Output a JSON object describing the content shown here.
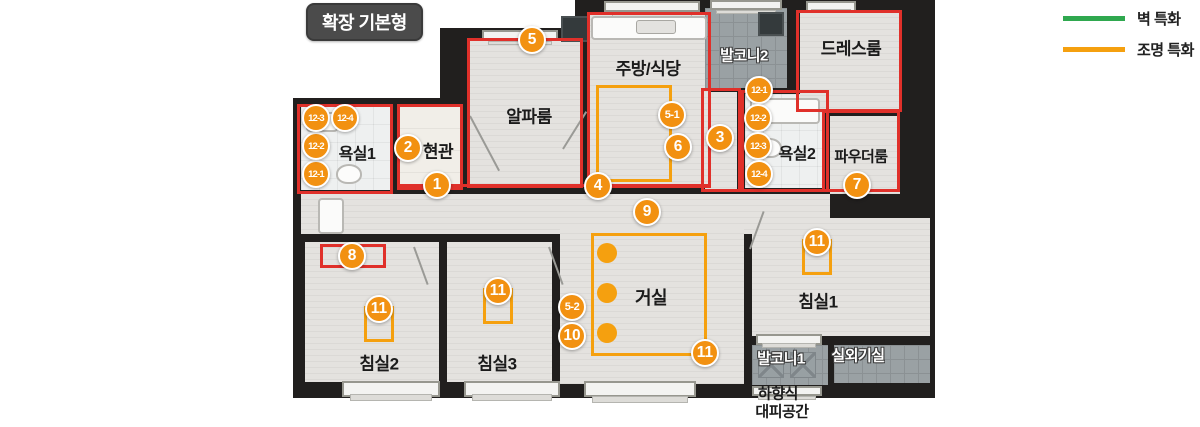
{
  "title": "확장 기본형",
  "legend": {
    "items": [
      {
        "label": "벽 특화",
        "color": "#2fa84f"
      },
      {
        "label": "조명 특화",
        "color": "#f5a00f"
      }
    ]
  },
  "colors": {
    "wall": "#211f1e",
    "wall_highlight_red": "#e0302a",
    "lighting_orange": "#f5a00f",
    "marker_orange": "#f29111",
    "legend_green": "#2fa84f"
  },
  "plan": {
    "walls": [
      [
        293,
        98,
        167,
        300
      ],
      [
        440,
        28,
        150,
        370
      ],
      [
        575,
        0,
        360,
        398
      ]
    ],
    "floors": [
      {
        "kind": "bath",
        "r": [
          301,
          106,
          90,
          84
        ]
      },
      {
        "kind": "entry",
        "r": [
          399,
          106,
          62,
          84
        ]
      },
      {
        "kind": "wood",
        "r": [
          469,
          40,
          112,
          146
        ]
      },
      {
        "kind": "wood",
        "r": [
          589,
          14,
          120,
          172
        ]
      },
      {
        "kind": "wood",
        "r": [
          705,
          92,
          32,
          98
        ]
      },
      {
        "kind": "bath",
        "r": [
          745,
          94,
          80,
          94
        ]
      },
      {
        "kind": "balcony",
        "r": [
          705,
          8,
          82,
          80
        ]
      },
      {
        "kind": "wood",
        "r": [
          800,
          12,
          100,
          98
        ]
      },
      {
        "kind": "wood",
        "r": [
          830,
          116,
          70,
          78
        ]
      },
      {
        "kind": "wood",
        "r": [
          301,
          194,
          529,
          40
        ]
      },
      {
        "kind": "wood",
        "r": [
          560,
          228,
          184,
          156
        ]
      },
      {
        "kind": "wood",
        "r": [
          305,
          242,
          134,
          140
        ]
      },
      {
        "kind": "wood",
        "r": [
          447,
          242,
          105,
          140
        ]
      },
      {
        "kind": "wood",
        "r": [
          752,
          218,
          178,
          118
        ]
      },
      {
        "kind": "balcony",
        "r": [
          752,
          345,
          76,
          40
        ]
      },
      {
        "kind": "balcony",
        "r": [
          834,
          345,
          96,
          38
        ]
      }
    ],
    "windows": [
      [
        604,
        1,
        96,
        11
      ],
      [
        710,
        0,
        72,
        10
      ],
      [
        806,
        1,
        50,
        11
      ],
      [
        482,
        30,
        76,
        10
      ],
      [
        342,
        381,
        98,
        16
      ],
      [
        464,
        381,
        96,
        16
      ],
      [
        584,
        381,
        112,
        16
      ],
      [
        756,
        334,
        66,
        11
      ],
      [
        752,
        386,
        70,
        10
      ]
    ],
    "red_boxes": [
      [
        297,
        104,
        96,
        90
      ],
      [
        397,
        104,
        66,
        86
      ],
      [
        467,
        38,
        116,
        150
      ],
      [
        587,
        12,
        124,
        176
      ],
      [
        701,
        88,
        40,
        104
      ],
      [
        741,
        90,
        88,
        102
      ],
      [
        796,
        10,
        106,
        102
      ],
      [
        822,
        110,
        78,
        82
      ],
      [
        320,
        244,
        66,
        24
      ]
    ],
    "red_lines": [
      [
        399,
        184,
        312,
        3
      ]
    ],
    "orange_boxes": [
      [
        596,
        85,
        76,
        97
      ],
      [
        591,
        233,
        116,
        123
      ]
    ],
    "u_shapes": [
      [
        364,
        306,
        30,
        36
      ],
      [
        483,
        288,
        30,
        36
      ],
      [
        802,
        239,
        30,
        36
      ]
    ],
    "dots": [
      [
        607,
        253
      ],
      [
        607,
        293
      ],
      [
        607,
        333
      ]
    ],
    "fixtures": [
      {
        "kind": "white",
        "r": [
          591,
          16,
          116,
          24
        ]
      },
      {
        "kind": "gray",
        "r": [
          636,
          20,
          40,
          14
        ]
      },
      {
        "kind": "oval",
        "r": [
          336,
          164,
          26,
          20
        ]
      },
      {
        "kind": "white",
        "r": [
          306,
          112,
          32,
          20
        ]
      },
      {
        "kind": "white",
        "r": [
          318,
          198,
          26,
          36
        ]
      },
      {
        "kind": "white",
        "r": [
          750,
          98,
          70,
          26
        ]
      },
      {
        "kind": "oval",
        "r": [
          758,
          138,
          24,
          20
        ]
      },
      {
        "kind": "shaft",
        "r": [
          561,
          16,
          28,
          26
        ]
      },
      {
        "kind": "shaft",
        "r": [
          758,
          12,
          26,
          24
        ]
      },
      {
        "kind": "hatch",
        "r": [
          758,
          352,
          26,
          26
        ]
      },
      {
        "kind": "hatch",
        "r": [
          790,
          352,
          26,
          26
        ]
      }
    ],
    "door_lines": [
      {
        "x": 470,
        "y": 115,
        "len": 62,
        "angle": 62
      },
      {
        "x": 563,
        "y": 148,
        "len": 44,
        "angle": -58
      },
      {
        "x": 414,
        "y": 246,
        "len": 40,
        "angle": 70
      },
      {
        "x": 549,
        "y": 246,
        "len": 40,
        "angle": 70
      },
      {
        "x": 750,
        "y": 248,
        "len": 40,
        "angle": -70
      }
    ],
    "labels": [
      {
        "text": "욕실1",
        "x": 357,
        "y": 152,
        "variant": "dark",
        "size": 16
      },
      {
        "text": "현관",
        "x": 438,
        "y": 150,
        "variant": "dark",
        "size": 17
      },
      {
        "text": "알파룸",
        "x": 529,
        "y": 115,
        "variant": "dark",
        "size": 17
      },
      {
        "text": "주방/식당",
        "x": 648,
        "y": 67,
        "variant": "dark",
        "size": 17
      },
      {
        "text": "발코니2",
        "x": 744,
        "y": 55,
        "variant": "light",
        "size": 15
      },
      {
        "text": "드레스룸",
        "x": 851,
        "y": 47,
        "variant": "dark",
        "size": 17
      },
      {
        "text": "욕실2",
        "x": 797,
        "y": 152,
        "variant": "dark",
        "size": 16
      },
      {
        "text": "파우더룸",
        "x": 861,
        "y": 156,
        "variant": "dark",
        "size": 15
      },
      {
        "text": "거실",
        "x": 651,
        "y": 297,
        "variant": "dark",
        "size": 18
      },
      {
        "text": "침실1",
        "x": 818,
        "y": 300,
        "variant": "dark",
        "size": 17
      },
      {
        "text": "침실2",
        "x": 379,
        "y": 362,
        "variant": "dark",
        "size": 17
      },
      {
        "text": "침실3",
        "x": 497,
        "y": 362,
        "variant": "dark",
        "size": 17
      },
      {
        "text": "발코니1",
        "x": 781,
        "y": 358,
        "variant": "light",
        "size": 15
      },
      {
        "text": "실외기실",
        "x": 858,
        "y": 355,
        "variant": "light",
        "size": 15
      },
      {
        "text": "하향식",
        "x": 778,
        "y": 393,
        "variant": "dark",
        "size": 15
      },
      {
        "text": "대피공간",
        "x": 782,
        "y": 411,
        "variant": "dark",
        "size": 15
      }
    ],
    "markers": [
      {
        "label": "1",
        "x": 437,
        "y": 185
      },
      {
        "label": "2",
        "x": 408,
        "y": 148
      },
      {
        "label": "3",
        "x": 720,
        "y": 138
      },
      {
        "label": "4",
        "x": 598,
        "y": 186
      },
      {
        "label": "5",
        "x": 532,
        "y": 40
      },
      {
        "label": "5-1",
        "x": 672,
        "y": 115
      },
      {
        "label": "6",
        "x": 678,
        "y": 147
      },
      {
        "label": "7",
        "x": 857,
        "y": 185
      },
      {
        "label": "8",
        "x": 352,
        "y": 256
      },
      {
        "label": "9",
        "x": 647,
        "y": 212
      },
      {
        "label": "5-2",
        "x": 572,
        "y": 307
      },
      {
        "label": "10",
        "x": 572,
        "y": 336
      },
      {
        "label": "11",
        "x": 705,
        "y": 353
      },
      {
        "label": "11",
        "x": 379,
        "y": 309
      },
      {
        "label": "11",
        "x": 498,
        "y": 291
      },
      {
        "label": "11",
        "x": 817,
        "y": 242
      },
      {
        "label": "12-1",
        "x": 316,
        "y": 174
      },
      {
        "label": "12-2",
        "x": 316,
        "y": 146
      },
      {
        "label": "12-3",
        "x": 316,
        "y": 118
      },
      {
        "label": "12-4",
        "x": 345,
        "y": 118
      },
      {
        "label": "12-1",
        "x": 759,
        "y": 90
      },
      {
        "label": "12-2",
        "x": 758,
        "y": 118
      },
      {
        "label": "12-3",
        "x": 758,
        "y": 146
      },
      {
        "label": "12-4",
        "x": 759,
        "y": 174
      }
    ]
  }
}
